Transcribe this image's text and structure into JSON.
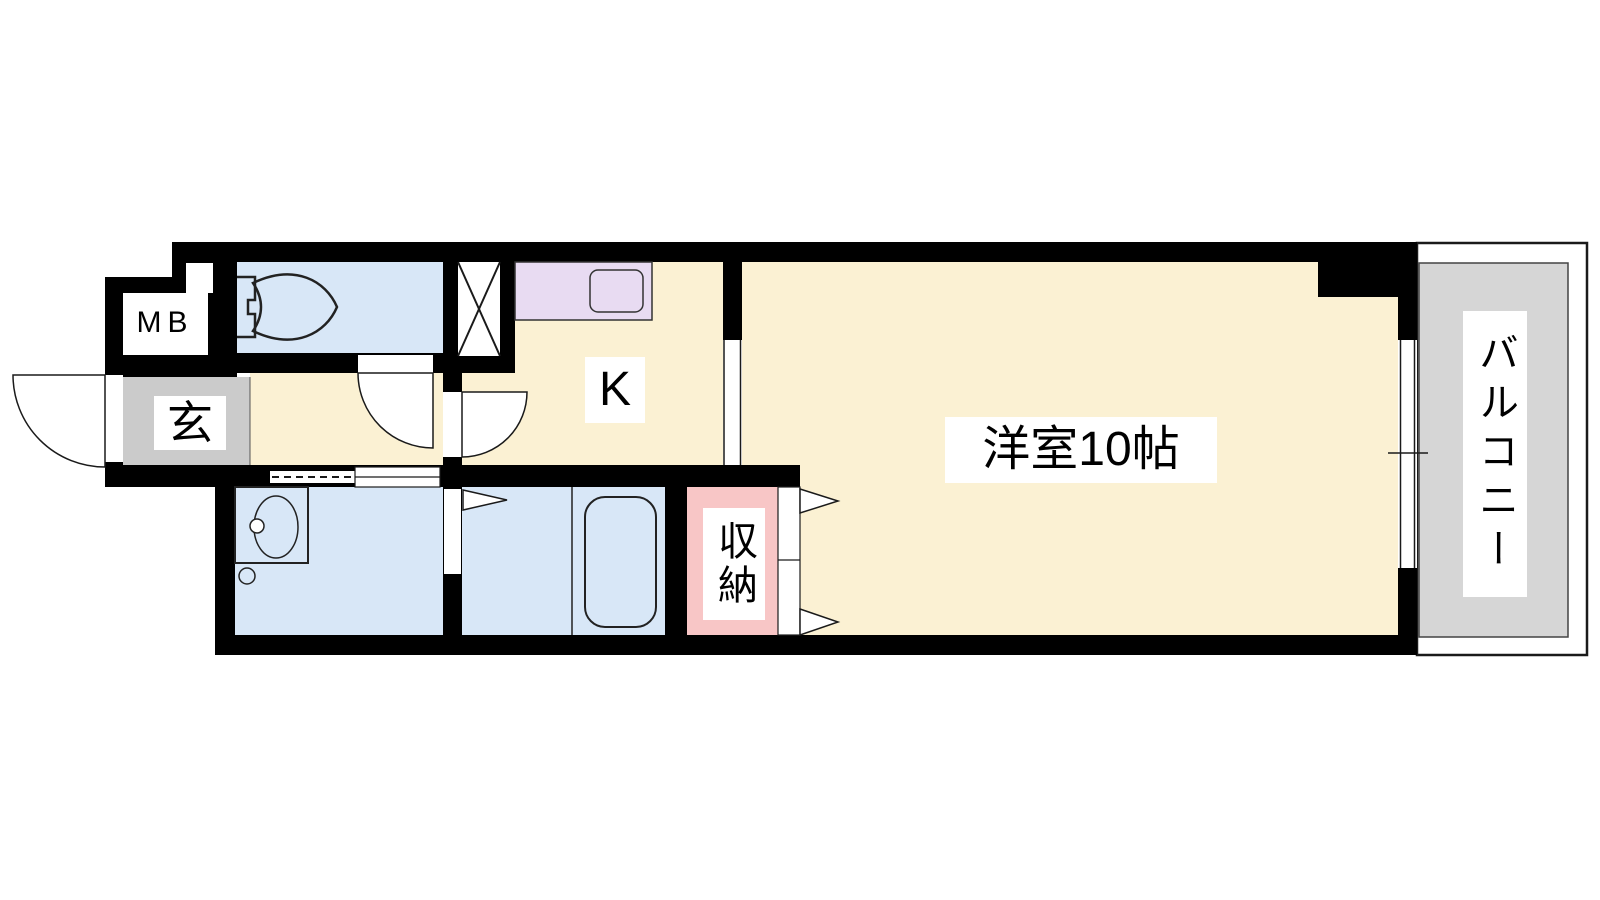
{
  "floor_plan": {
    "labels": {
      "meter_box": "MB",
      "entrance": "玄",
      "kitchen": "K",
      "main_room": "洋室10帖",
      "storage": "収納",
      "balcony": "バルコニー"
    },
    "colors": {
      "wall": "#000000",
      "floor_cream": "#FBF1D3",
      "wet_area_blue": "#D8E7F7",
      "kitchen_counter": "#E8DBF2",
      "storage_pink": "#F8C6C6",
      "entrance_gray": "#CBCBCB",
      "balcony_gray": "#D6D6D6",
      "line": "#1A1A1A"
    }
  }
}
